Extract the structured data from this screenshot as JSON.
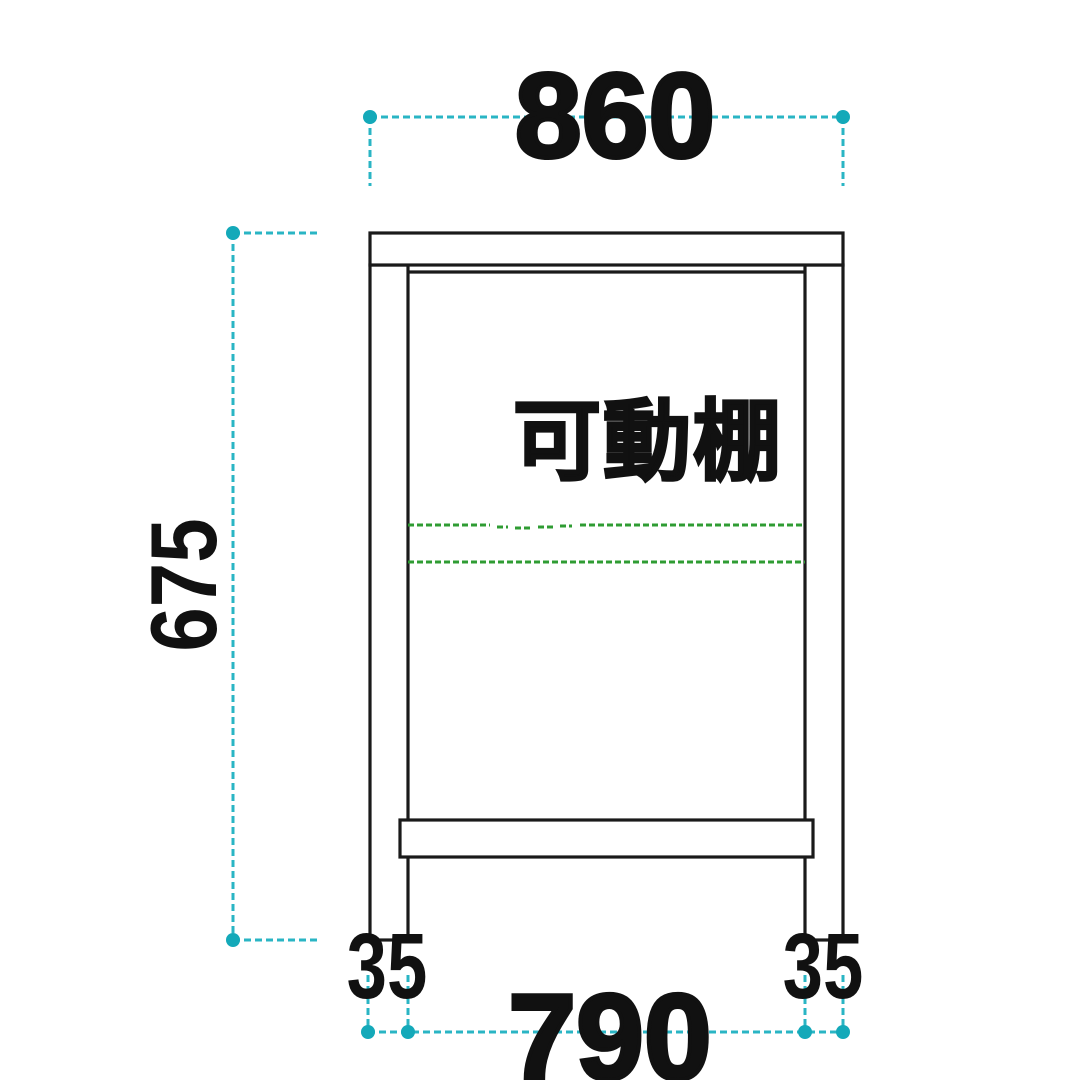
{
  "drawing": {
    "shelf_label": "可動棚",
    "dim_top_width": "860",
    "dim_side_height": "675",
    "dim_leg_left": "35",
    "dim_leg_right": "35",
    "dim_bottom_span": "790",
    "colors": {
      "dimension_teal": "#2ab5c4",
      "dimension_dot": "#14a9b9",
      "shelf_line_green": "#2f9c33",
      "outline_black": "#1a1a1a",
      "text_black": "#111111"
    }
  }
}
